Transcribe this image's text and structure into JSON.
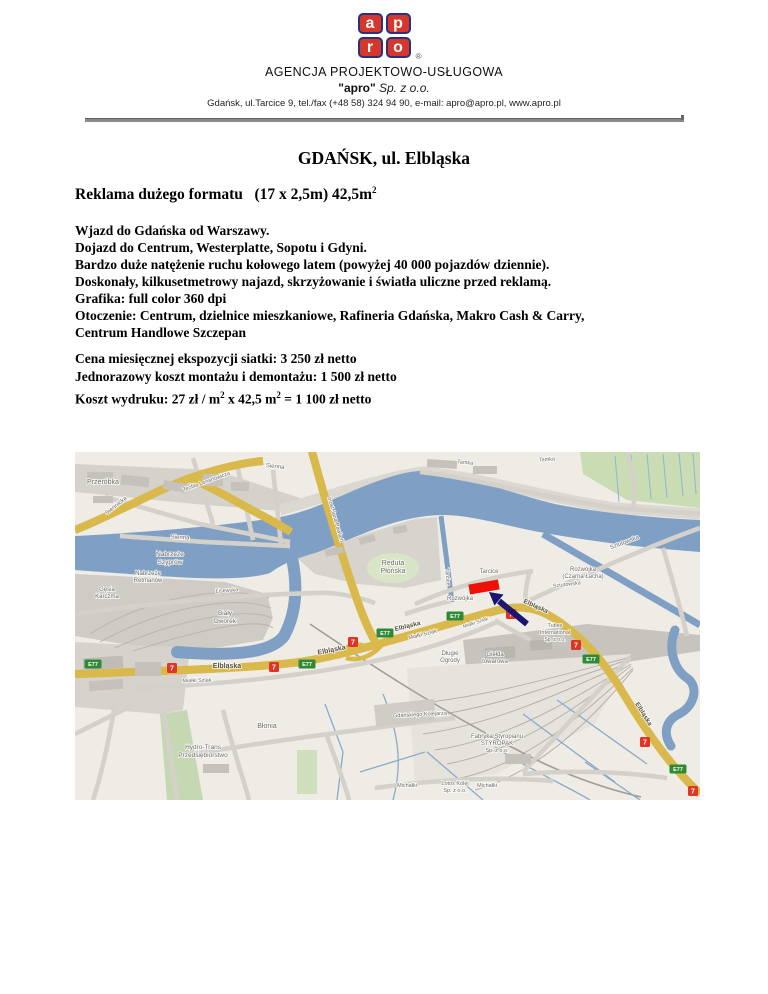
{
  "header": {
    "logo": {
      "letters": [
        "a",
        "p",
        "r",
        "o"
      ],
      "registered": "®",
      "red": "#d6372c",
      "navy": "#27317f"
    },
    "line1": "AGENCJA PROJEKTOWO-USŁUGOWA",
    "line2_brand": "\"apro\"",
    "line2_rest": " Sp. z o.o.",
    "line3": "Gdańsk, ul.Tarcice 9, tel./fax (+48 58) 324 94 90, e-mail: apro@apro.pl, www.apro.pl"
  },
  "title": "GDAŃSK, ul. Elbląska",
  "subtitle": {
    "text": "Reklama dużego formatu   (17 x 2,5m) 42,5m",
    "sup": "2"
  },
  "body": [
    "Wjazd do Gdańska od Warszawy.",
    "Dojazd do Centrum, Westerplatte, Sopotu i Gdyni.",
    "Bardzo duże natężenie ruchu kołowego latem (powyżej 40 000 pojazdów dziennie).",
    "Doskonały, kilkusetmetrowy najazd, skrzyżowanie i światła uliczne przed reklamą.",
    "Grafika: full color 360 dpi",
    "Otoczenie: Centrum, dzielnice mieszkaniowe, Rafineria Gdańska, Makro Cash & Carry,",
    "Centrum Handlowe Szczepan"
  ],
  "pricing": {
    "line1": "Cena miesięcznej ekspozycji siatki: 3 250 zł netto",
    "line2": "Jednorazowy koszt montażu i demontażu: 1 500 zł netto",
    "line3": {
      "p1": "Koszt wydruku: 27 zł / m",
      "s1": "2",
      "p2": " x 42,5 m",
      "s2": "2",
      "p3": " = 1 100 zł netto"
    }
  },
  "map": {
    "water_color": "#7fa0c4",
    "land_color": "#efece6",
    "road_yellow": "#f8ef6e",
    "marker_color": "#ee1108",
    "arrow_color": "#1b1470",
    "shield_green": "#2f8a36",
    "shield_red": "#df3526",
    "labels": [
      {
        "t": "Przeróbka",
        "x": 28,
        "y": 32,
        "s": 7
      },
      {
        "t": "Siennicka",
        "x": 42,
        "y": 55,
        "r": -38,
        "s": 6
      },
      {
        "t": "Teofila Lenartowicza",
        "x": 132,
        "y": 31,
        "r": -20,
        "s": 5.5
      },
      {
        "t": "Sienna",
        "x": 200,
        "y": 16,
        "r": 6,
        "s": 6
      },
      {
        "t": "Sienna",
        "x": 105,
        "y": 87,
        "r": 3,
        "s": 6
      },
      {
        "t": "Nabrzeże",
        "x": 95,
        "y": 104,
        "s": 6.5
      },
      {
        "t": "Szyprów",
        "x": 95,
        "y": 112,
        "s": 6.5
      },
      {
        "t": "Nabrzeże",
        "x": 73,
        "y": 123,
        "s": 6
      },
      {
        "t": "Retmanów",
        "x": 73,
        "y": 130,
        "s": 6
      },
      {
        "t": "Gęsia",
        "x": 32,
        "y": 139,
        "s": 6
      },
      {
        "t": "Karczma",
        "x": 32,
        "y": 146,
        "s": 6
      },
      {
        "t": "Biały",
        "x": 150,
        "y": 163,
        "s": 6.5
      },
      {
        "t": "Dworek",
        "x": 150,
        "y": 171,
        "s": 6.5
      },
      {
        "t": "Lisewska",
        "x": 152,
        "y": 140,
        "r": -4,
        "s": 5.5
      },
      {
        "t": "Reduta",
        "x": 318,
        "y": 113,
        "s": 7
      },
      {
        "t": "Płońska",
        "x": 318,
        "y": 121,
        "s": 7
      },
      {
        "t": "most Jana Pawła II",
        "x": 259,
        "y": 68,
        "r": 74,
        "s": 5.5
      },
      {
        "t": "Tamka",
        "x": 390,
        "y": 12,
        "r": 6,
        "s": 5.5
      },
      {
        "t": "Tamka",
        "x": 472,
        "y": 9,
        "r": -4,
        "s": 5.5
      },
      {
        "t": "Sztutowska",
        "x": 550,
        "y": 92,
        "r": -21,
        "s": 6
      },
      {
        "t": "Sztutowska",
        "x": 492,
        "y": 134,
        "r": -7,
        "s": 5.5
      },
      {
        "t": "Rozwójka",
        "x": 508,
        "y": 119,
        "s": 6
      },
      {
        "t": "(Czarna Łacha)",
        "x": 508,
        "y": 126,
        "s": 6
      },
      {
        "t": "Tarcice",
        "x": 414,
        "y": 121,
        "s": 6
      },
      {
        "t": "Tarcice",
        "x": 371,
        "y": 125,
        "r": 85,
        "s": 5.5
      },
      {
        "t": "Rozwójka",
        "x": 385,
        "y": 148,
        "s": 6
      },
      {
        "t": "Elbląska",
        "x": 152,
        "y": 216,
        "b": 1,
        "s": 7
      },
      {
        "t": "Elbląska",
        "x": 257,
        "y": 200,
        "r": -11,
        "b": 1,
        "s": 7
      },
      {
        "t": "Elbląska",
        "x": 333,
        "y": 176,
        "r": -14,
        "b": 1,
        "s": 6.5
      },
      {
        "t": "Elbląska",
        "x": 460,
        "y": 156,
        "r": 24,
        "b": 1,
        "s": 6.5
      },
      {
        "t": "Elbląska",
        "x": 567,
        "y": 263,
        "r": 58,
        "b": 1,
        "s": 6.5
      },
      {
        "t": "Miałki Szlak",
        "x": 122,
        "y": 230,
        "r": -2,
        "s": 5.5
      },
      {
        "t": "Miałki Szlak",
        "x": 348,
        "y": 184,
        "r": -14,
        "s": 5.5
      },
      {
        "t": "Miałki Szlak",
        "x": 401,
        "y": 172,
        "r": -18,
        "s": 5
      },
      {
        "t": "Tubes",
        "x": 480,
        "y": 175,
        "s": 5.5
      },
      {
        "t": "International",
        "x": 480,
        "y": 182,
        "s": 5.5
      },
      {
        "t": "Sp. z o.o.",
        "x": 480,
        "y": 189,
        "s": 5
      },
      {
        "t": "Długie",
        "x": 375,
        "y": 203,
        "s": 6
      },
      {
        "t": "Ogrody",
        "x": 375,
        "y": 210,
        "s": 6
      },
      {
        "t": "Giełda",
        "x": 420,
        "y": 204,
        "s": 6
      },
      {
        "t": "towarowa",
        "x": 420,
        "y": 211,
        "s": 6
      },
      {
        "t": "Błonia",
        "x": 192,
        "y": 276,
        "s": 7
      },
      {
        "t": "Hydro-Trans",
        "x": 128,
        "y": 297,
        "s": 6.5
      },
      {
        "t": "Przedsiębiorstwo",
        "x": 128,
        "y": 305,
        "s": 6.5
      },
      {
        "t": "Fabryka Styropianu",
        "x": 422,
        "y": 286,
        "s": 6
      },
      {
        "t": "STYROPAK",
        "x": 422,
        "y": 293,
        "s": 6
      },
      {
        "t": "Sp. z o.o.",
        "x": 422,
        "y": 300,
        "s": 5.5
      },
      {
        "t": "Lotos Kolej",
        "x": 380,
        "y": 333,
        "s": 5.5
      },
      {
        "t": "Sp. z o.o.",
        "x": 380,
        "y": 340,
        "s": 5.5
      },
      {
        "t": "Michałki",
        "x": 332,
        "y": 335,
        "s": 5.5
      },
      {
        "t": "Michałki",
        "x": 412,
        "y": 335,
        "s": 5.5
      },
      {
        "t": "Gdańskiego Kolejarza",
        "x": 345,
        "y": 264,
        "r": -3,
        "s": 5.5
      }
    ],
    "shields": [
      {
        "k": "E77",
        "x": 18,
        "y": 212
      },
      {
        "k": "7",
        "x": 97,
        "y": 216
      },
      {
        "k": "7",
        "x": 199,
        "y": 215
      },
      {
        "k": "E77",
        "x": 232,
        "y": 212
      },
      {
        "k": "7",
        "x": 278,
        "y": 190
      },
      {
        "k": "E77",
        "x": 310,
        "y": 181
      },
      {
        "k": "E77",
        "x": 380,
        "y": 164
      },
      {
        "k": "7",
        "x": 436,
        "y": 162
      },
      {
        "k": "7",
        "x": 501,
        "y": 193
      },
      {
        "k": "E77",
        "x": 516,
        "y": 207
      },
      {
        "k": "7",
        "x": 570,
        "y": 290
      },
      {
        "k": "E77",
        "x": 603,
        "y": 317
      },
      {
        "k": "7",
        "x": 618,
        "y": 339
      }
    ]
  }
}
